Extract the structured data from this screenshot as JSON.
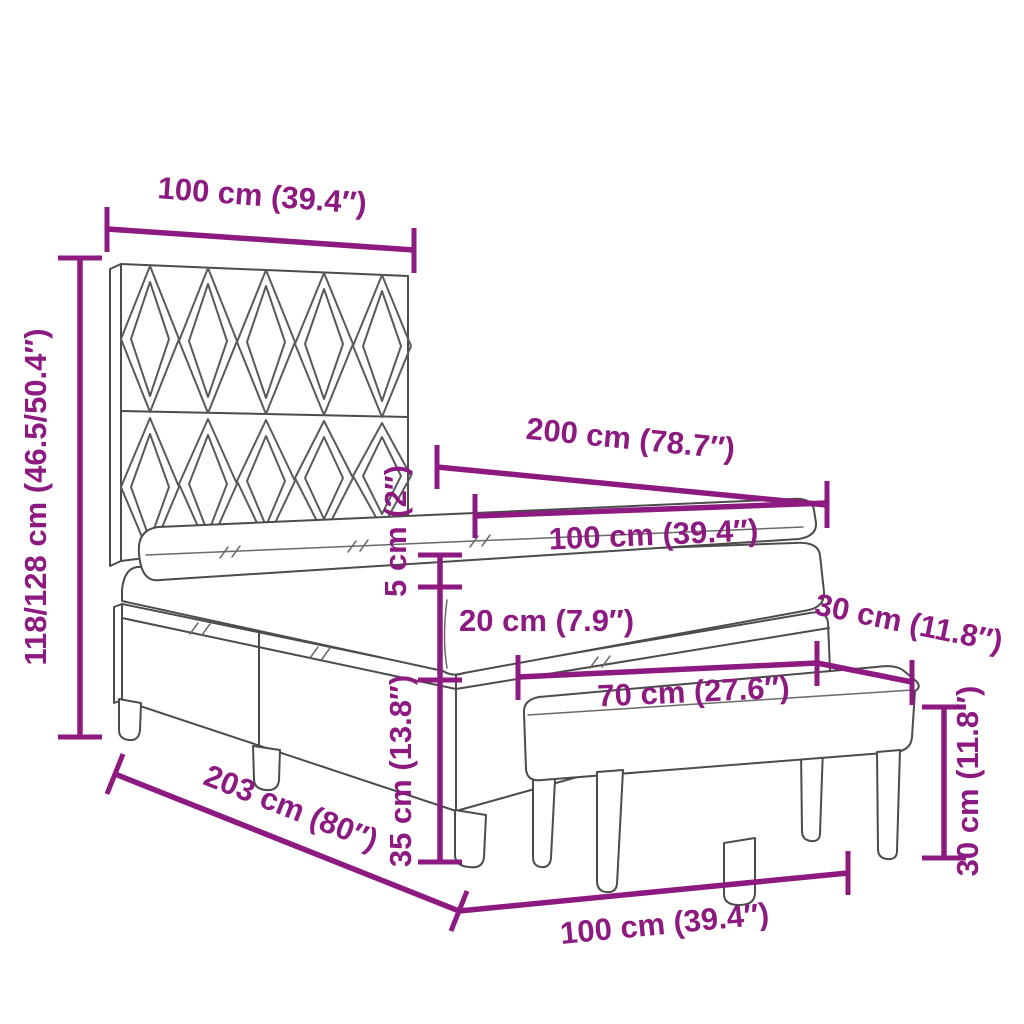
{
  "title": "Box spring bed with headboard and bench - dimension diagram",
  "colors": {
    "accent": "#8D1A80",
    "line": "#4C4C4C",
    "background": "#FFFFFF"
  },
  "dims": {
    "headboard_width": {
      "label": "100 cm (39.4″)"
    },
    "total_height": {
      "label": "118/128 cm (46.5/50.4″)"
    },
    "bed_length_top": {
      "label": "200 cm (78.7″)"
    },
    "bed_width_top": {
      "label": "100 cm (39.4″)"
    },
    "topper_thickness": {
      "label": "5 cm (2″)"
    },
    "mattress_thickness": {
      "label": "20 cm (7.9″)"
    },
    "bench_depth": {
      "label": "30 cm (11.8″)"
    },
    "bench_length": {
      "label": "70 cm (27.6″)"
    },
    "base_height": {
      "label": "35 cm (13.8″)"
    },
    "bench_height": {
      "label": "30 cm (11.8″)"
    },
    "bed_length_bottom": {
      "label": "203 cm (80″)"
    },
    "bed_width_bottom": {
      "label": "100 cm (39.4″)"
    }
  }
}
